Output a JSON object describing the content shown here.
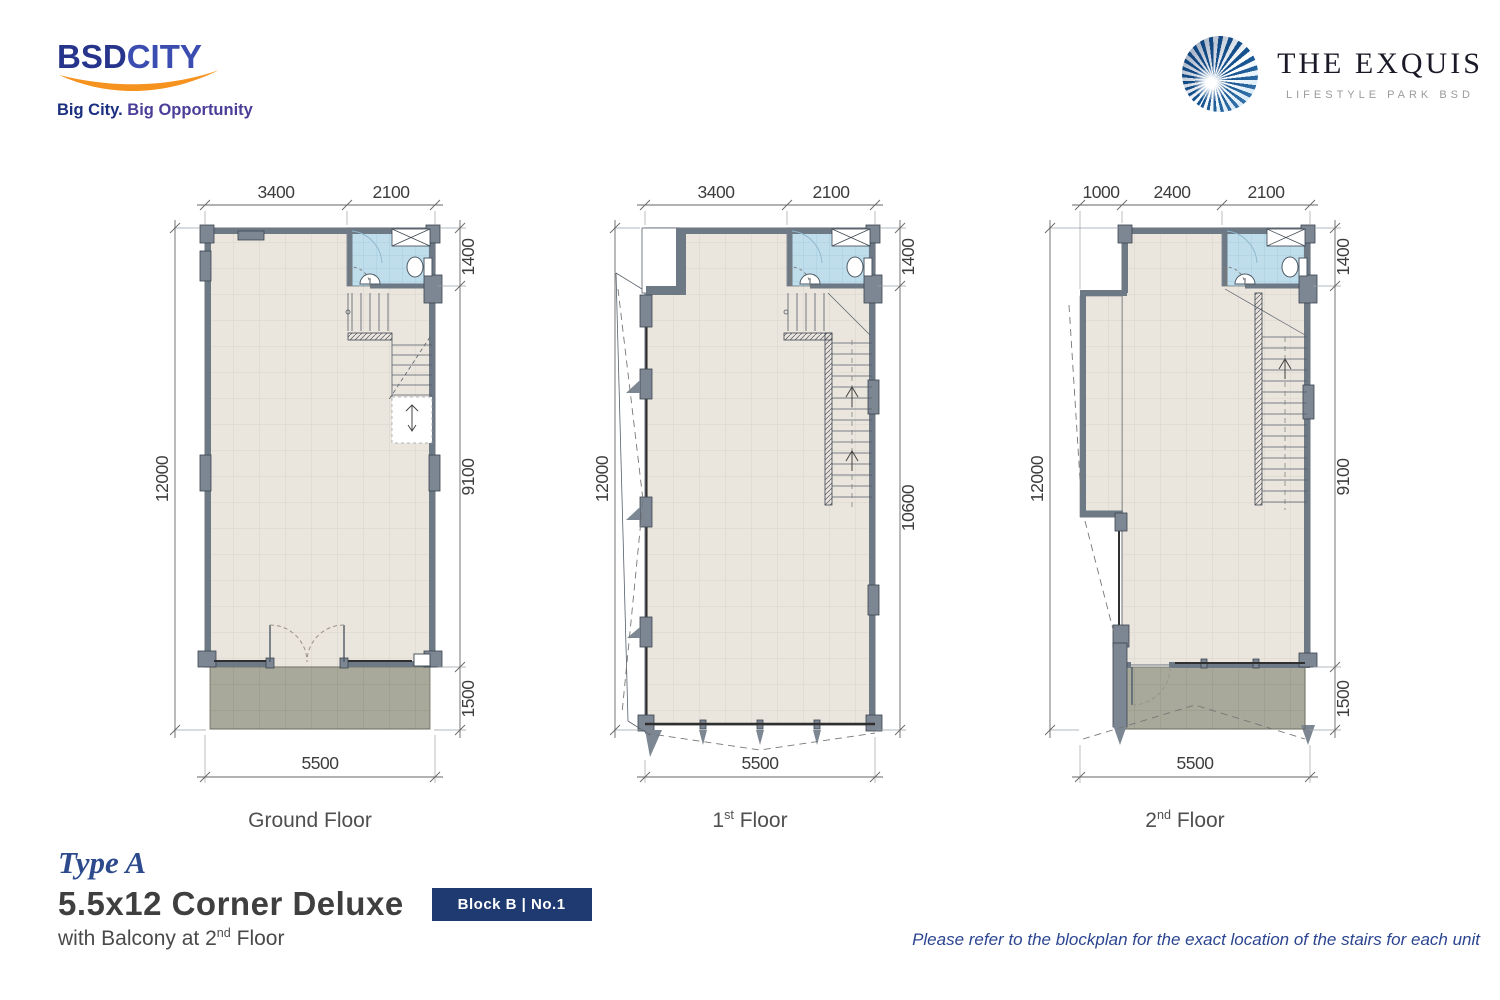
{
  "brand": {
    "bsd": {
      "name_bold": "BSD",
      "name_light": "CITY",
      "tagline_bold": "Big City.",
      "tagline_light": " Big Opportunity"
    },
    "exquis": {
      "name": "THE EXQUIS",
      "tagline": "LIFESTYLE PARK BSD"
    }
  },
  "plans": [
    {
      "id": "ground-floor",
      "label_num": "Ground",
      "label_sup": "",
      "label_rest": " Floor",
      "dims": {
        "top": [
          "3400",
          "2100"
        ],
        "bottom": "5500",
        "left": "12000",
        "right": [
          "1400",
          "9100",
          "1500"
        ]
      }
    },
    {
      "id": "first-floor",
      "label_num": "1",
      "label_sup": "st",
      "label_rest": " Floor",
      "dims": {
        "top": [
          "3400",
          "2100"
        ],
        "bottom": "5500",
        "left": "12000",
        "right": [
          "1400",
          "10600"
        ]
      }
    },
    {
      "id": "second-floor",
      "label_num": "2",
      "label_sup": "nd",
      "label_rest": " Floor",
      "dims": {
        "top": [
          "1000",
          "2400",
          "2100"
        ],
        "bottom": "5500",
        "left": "12000",
        "right": [
          "1400",
          "9100",
          "1500"
        ]
      }
    }
  ],
  "title_block": {
    "type": "Type A",
    "title": "5.5x12 Corner Deluxe",
    "badge": "Block B | No.1",
    "subtitle_main": "with Balcony at 2",
    "subtitle_sup": "nd",
    "subtitle_rest": " Floor"
  },
  "footnote": "Please refer to the blockplan for the exact location of the stairs for each unit",
  "colors": {
    "navy": "#1e3a70",
    "bsd_blue": "#27348b",
    "orange": "#f6921e",
    "wall_gray": "#6e7986",
    "floor_tile": "#eae5dd",
    "bath_blue": "#bfddeb",
    "terrace_gray": "#a8a99b"
  }
}
